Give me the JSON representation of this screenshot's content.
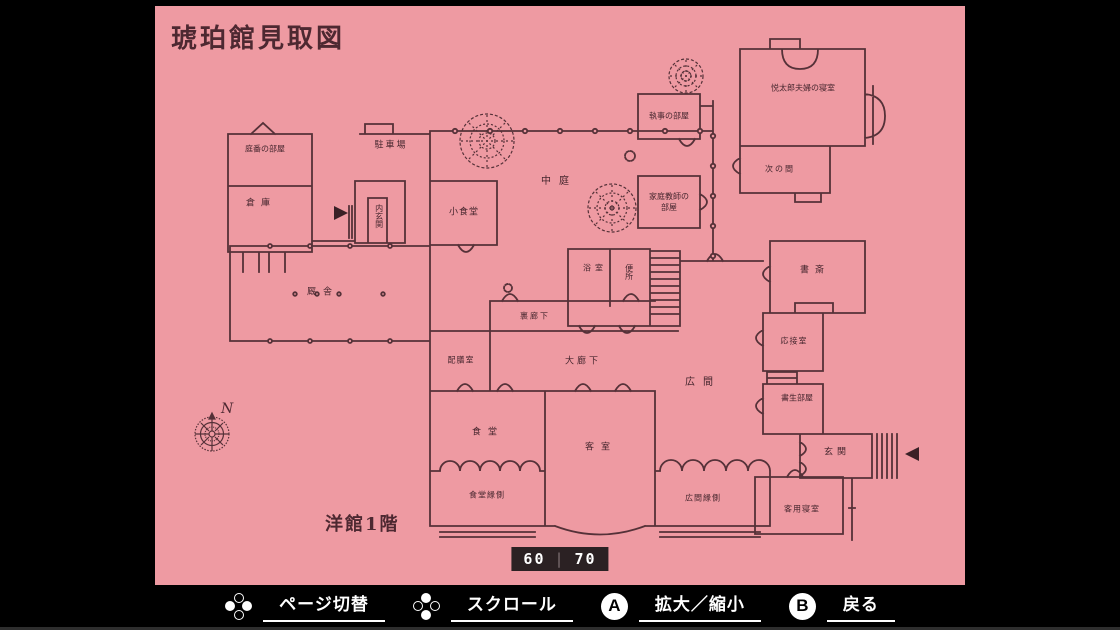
{
  "page": {
    "title": "琥珀館見取図",
    "floor_label": "洋館1階",
    "pager": {
      "left": "60",
      "divider": "|",
      "right": "70"
    }
  },
  "colors": {
    "page_bg": "#ee9aa2",
    "ink": "#553138",
    "label_ink": "#46262e",
    "pager_bg": "#2b2123",
    "bar_bg": "#000000"
  },
  "map": {
    "compass_label": "N",
    "rooms": [
      {
        "label": "庭番の部屋",
        "x": 110,
        "y": 143,
        "fs": 8
      },
      {
        "label": "倉庫",
        "x": 106,
        "y": 198,
        "fs": 9,
        "ls": 6
      },
      {
        "label": "駐車場",
        "x": 236,
        "y": 140,
        "fs": 9,
        "ls": 2
      },
      {
        "label": "内玄関",
        "x": 224,
        "y": 210,
        "fs": 8,
        "vertical": true
      },
      {
        "label": "小食堂",
        "x": 309,
        "y": 207,
        "fs": 9,
        "ls": 1
      },
      {
        "label": "中庭",
        "x": 404,
        "y": 176,
        "fs": 10,
        "ls": 8
      },
      {
        "label": "執事の部屋",
        "x": 514,
        "y": 110,
        "fs": 8
      },
      {
        "label": "家庭教師の\n部屋",
        "x": 514,
        "y": 196,
        "fs": 8
      },
      {
        "label": "悦太郎夫婦の寝室",
        "x": 648,
        "y": 82,
        "fs": 8
      },
      {
        "label": "次の間",
        "x": 625,
        "y": 163,
        "fs": 8,
        "ls": 2
      },
      {
        "label": "浴室",
        "x": 440,
        "y": 262,
        "fs": 8,
        "ls": 4
      },
      {
        "label": "便所",
        "x": 474,
        "y": 266,
        "fs": 8,
        "vertical": true
      },
      {
        "label": "書斎",
        "x": 660,
        "y": 265,
        "fs": 9,
        "ls": 6
      },
      {
        "label": "応接室",
        "x": 639,
        "y": 335,
        "fs": 8,
        "ls": 1
      },
      {
        "label": "書生部屋",
        "x": 642,
        "y": 392,
        "fs": 8
      },
      {
        "label": "広間",
        "x": 548,
        "y": 377,
        "fs": 10,
        "ls": 8
      },
      {
        "label": "裏廊下",
        "x": 380,
        "y": 310,
        "fs": 8,
        "ls": 2
      },
      {
        "label": "配膳室",
        "x": 306,
        "y": 354,
        "fs": 8,
        "ls": 1
      },
      {
        "label": "大廊下",
        "x": 428,
        "y": 356,
        "fs": 9,
        "ls": 3
      },
      {
        "label": "厩舎",
        "x": 168,
        "y": 287,
        "fs": 9,
        "ls": 7
      },
      {
        "label": "食堂",
        "x": 333,
        "y": 427,
        "fs": 9,
        "ls": 7
      },
      {
        "label": "客室",
        "x": 446,
        "y": 442,
        "fs": 9,
        "ls": 7
      },
      {
        "label": "食堂縁側",
        "x": 332,
        "y": 489,
        "fs": 8,
        "ls": 1
      },
      {
        "label": "広間縁側",
        "x": 548,
        "y": 492,
        "fs": 8,
        "ls": 1
      },
      {
        "label": "玄関",
        "x": 682,
        "y": 447,
        "fs": 9,
        "ls": 4
      },
      {
        "label": "客用寝室",
        "x": 647,
        "y": 503,
        "fs": 8,
        "ls": 1
      }
    ]
  },
  "controls": [
    {
      "type": "dpad-h",
      "name": "page-switch-control",
      "label": "ページ切替"
    },
    {
      "type": "dpad-v",
      "name": "scroll-control",
      "label": "スクロール"
    },
    {
      "type": "btn",
      "key": "A",
      "name": "zoom-control",
      "label": "拡大／縮小"
    },
    {
      "type": "btn",
      "key": "B",
      "name": "back-control",
      "label": "戻る"
    }
  ]
}
